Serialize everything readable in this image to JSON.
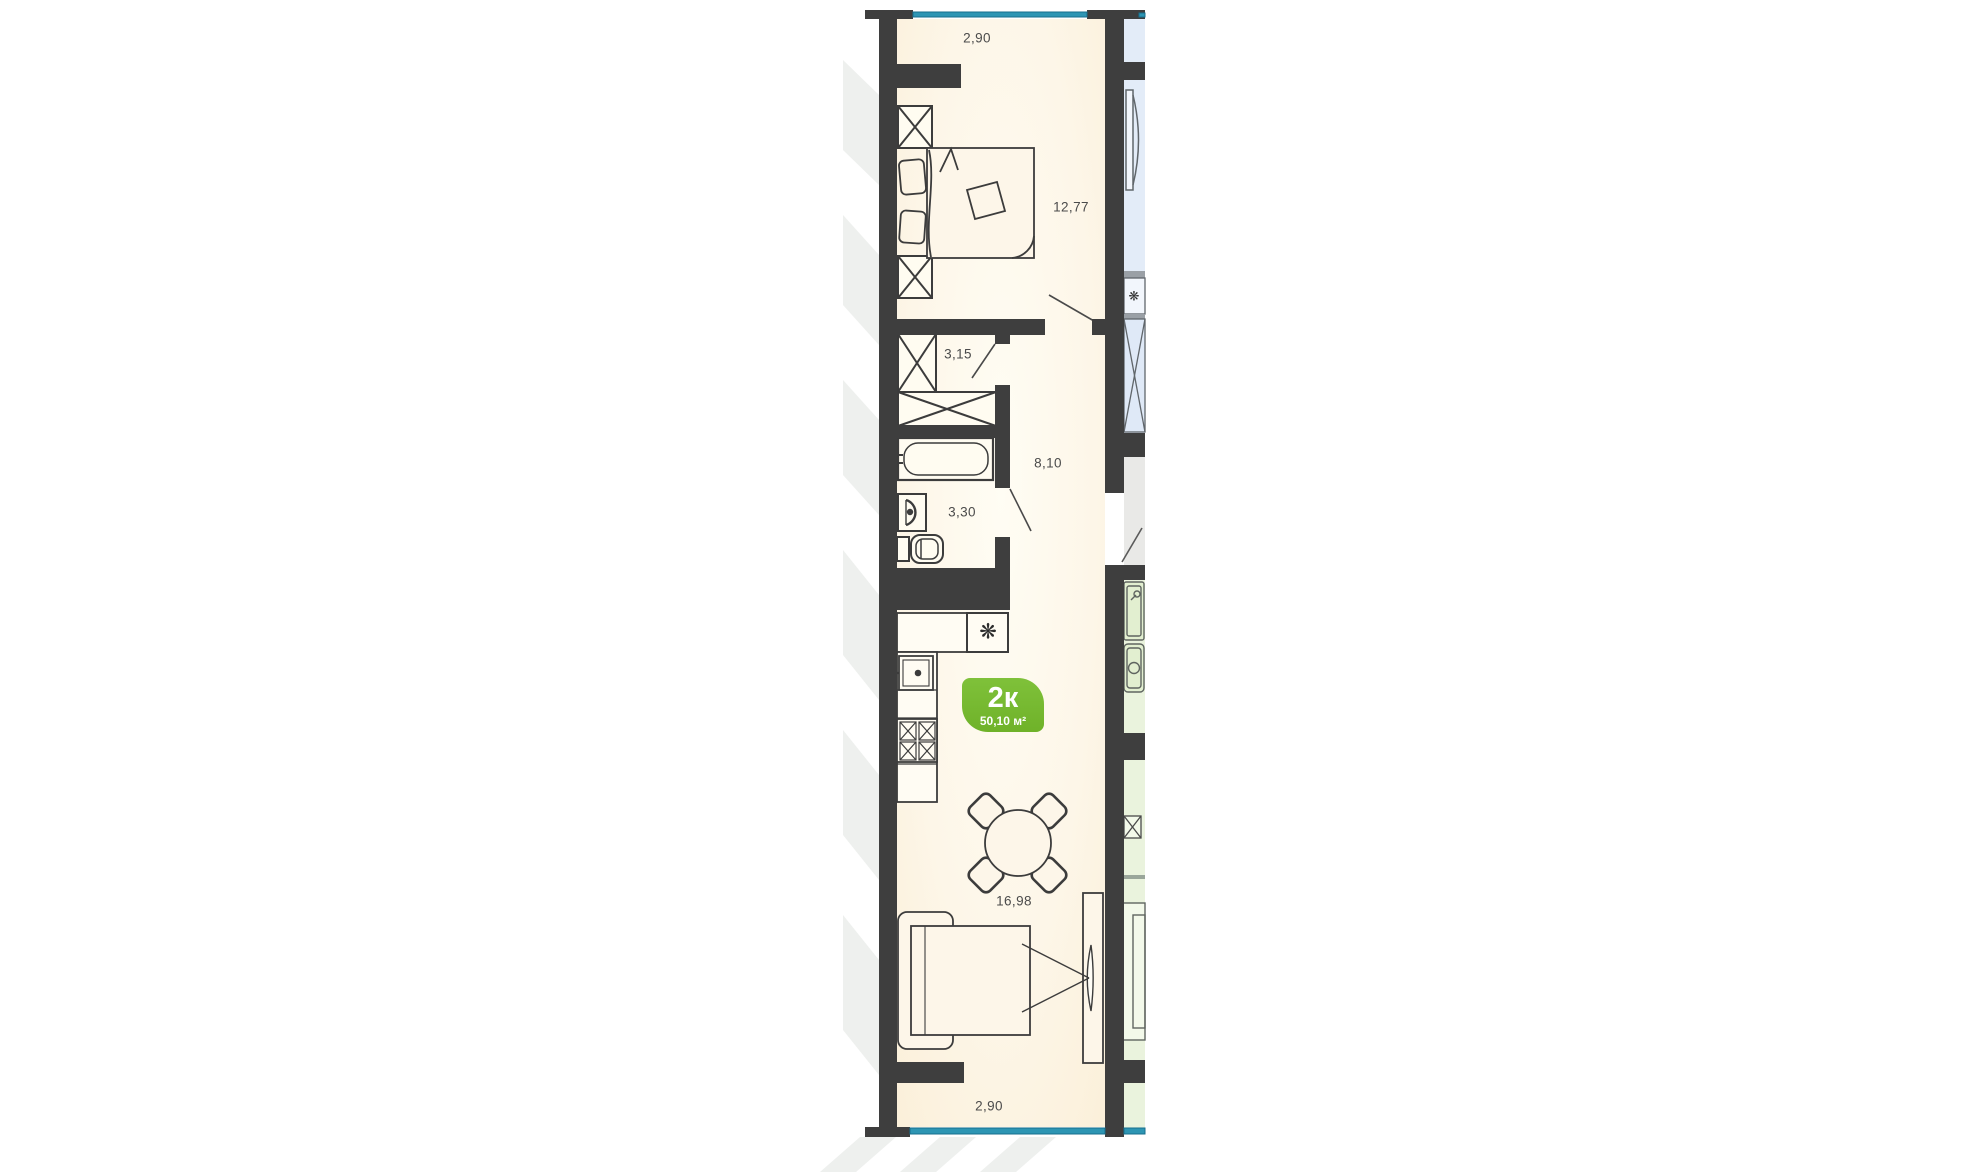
{
  "plan": {
    "unit_badge": {
      "rooms_label": "2к",
      "area_label": "50,10 м²"
    },
    "labels": {
      "top_width": "2,90",
      "bedroom_area": "12,77",
      "closet_area": "3,15",
      "hallway_area": "8,10",
      "bathroom_area": "3,30",
      "kitchen_living_area": "16,98",
      "bottom_width": "2,90"
    },
    "icons": {
      "fridge": "❋",
      "neighbor_fridge": "❋"
    },
    "colors": {
      "wall": "#3e3e3e",
      "room_fill": "#fcf3e2",
      "window_teal": "#2d95b3",
      "badge_green": "#76b82d",
      "neighbor_blue": "#e3ecf8",
      "neighbor_green": "#eaf3dd",
      "common_grey": "#e9e9e7",
      "label_text": "#4b4b4b"
    }
  }
}
